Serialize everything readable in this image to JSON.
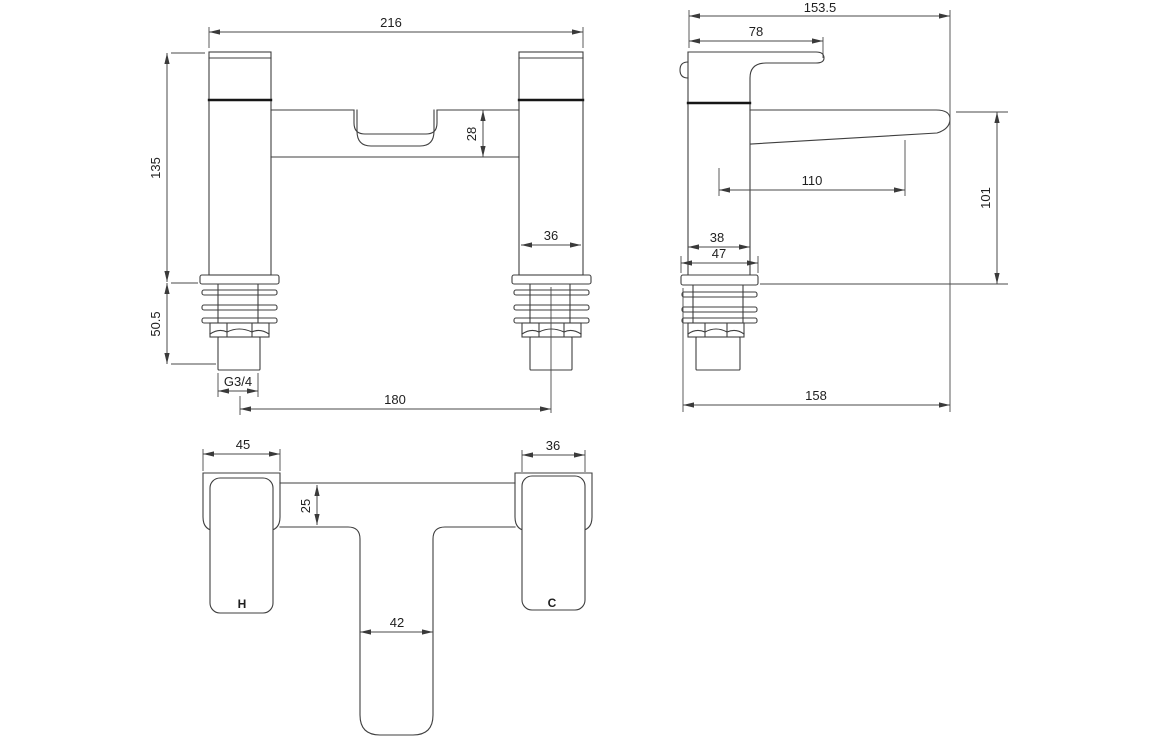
{
  "drawing": {
    "ink_color": "#3f3f3f",
    "front": {
      "overall_width": "216",
      "height": "135",
      "spout_drop": "28",
      "pillar_width": "36",
      "tail_length": "50.5",
      "thread_size": "G3/4",
      "hole_centres": "180"
    },
    "side": {
      "overall_depth": "153.5",
      "handle_reach": "78",
      "spout_reach": "110",
      "outlet_height": "101",
      "body_depth": "38",
      "flange_depth": "47",
      "overall_length": "158"
    },
    "plan": {
      "hot_handle_width": "45",
      "cold_handle_width": "36",
      "body_width": "25",
      "spout_width": "42",
      "hot_label": "H",
      "cold_label": "C"
    }
  }
}
